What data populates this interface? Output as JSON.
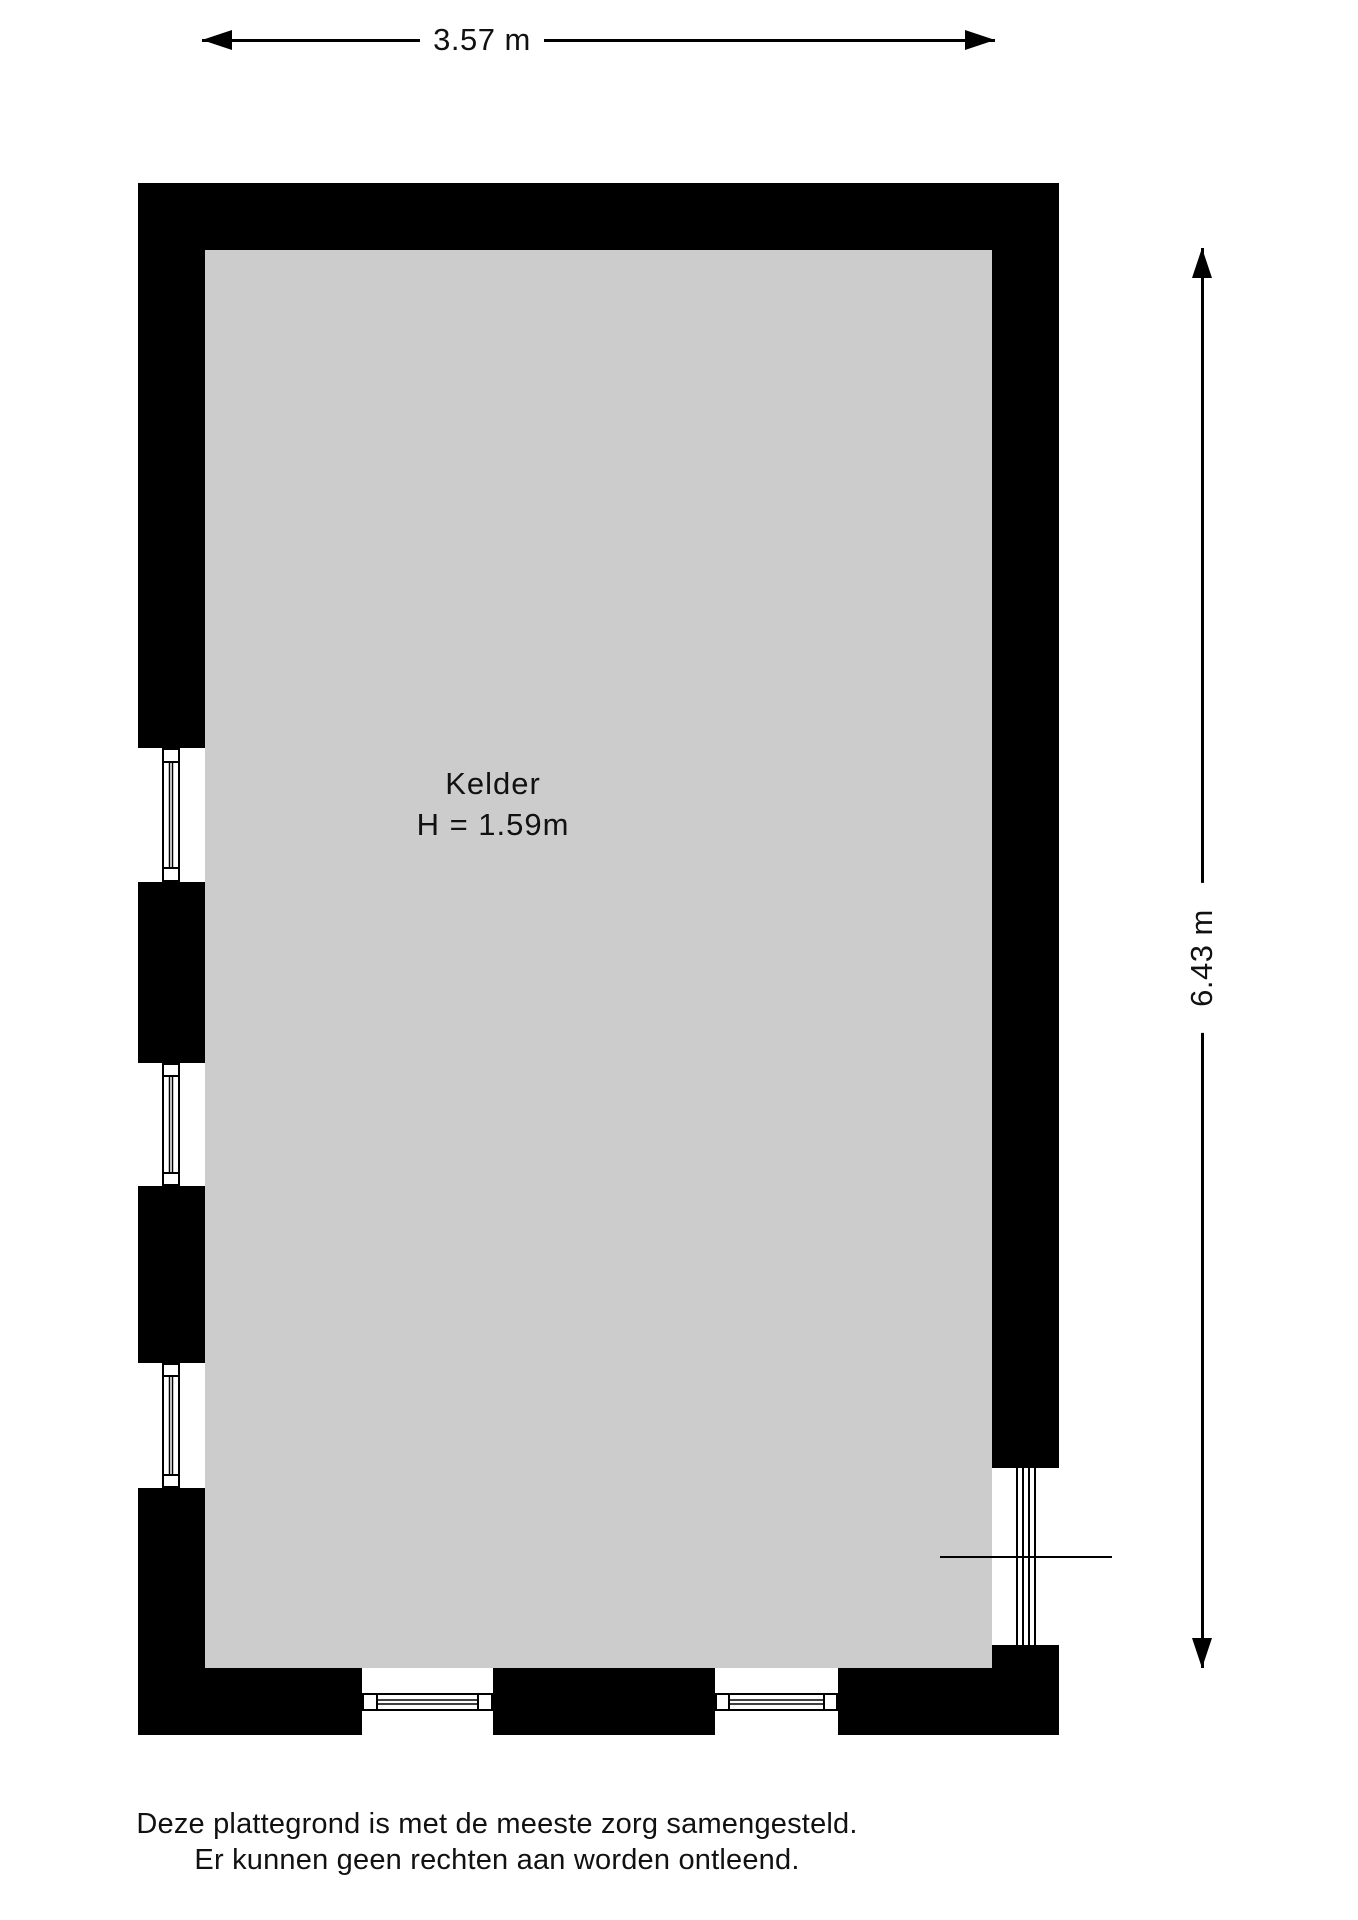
{
  "dimensions": {
    "width_label": "3.57 m",
    "height_label": "6.43 m"
  },
  "room": {
    "name": "Kelder",
    "ceiling_height": "H = 1.59m"
  },
  "footer": {
    "line1": "Deze plattegrond is met de meeste zorg samengesteld.",
    "line2": "Er kunnen geen rechten aan worden ontleend."
  },
  "colors": {
    "wall": "#000000",
    "floor": "#cccccc",
    "dimension_line": "#000000",
    "text": "#111111",
    "background": "#ffffff"
  },
  "icons": {
    "width_arrow_left": "arrow-left-icon",
    "width_arrow_right": "arrow-right-icon",
    "height_arrow_up": "arrow-up-icon",
    "height_arrow_down": "arrow-down-icon",
    "window": "window-glazing-icon"
  }
}
